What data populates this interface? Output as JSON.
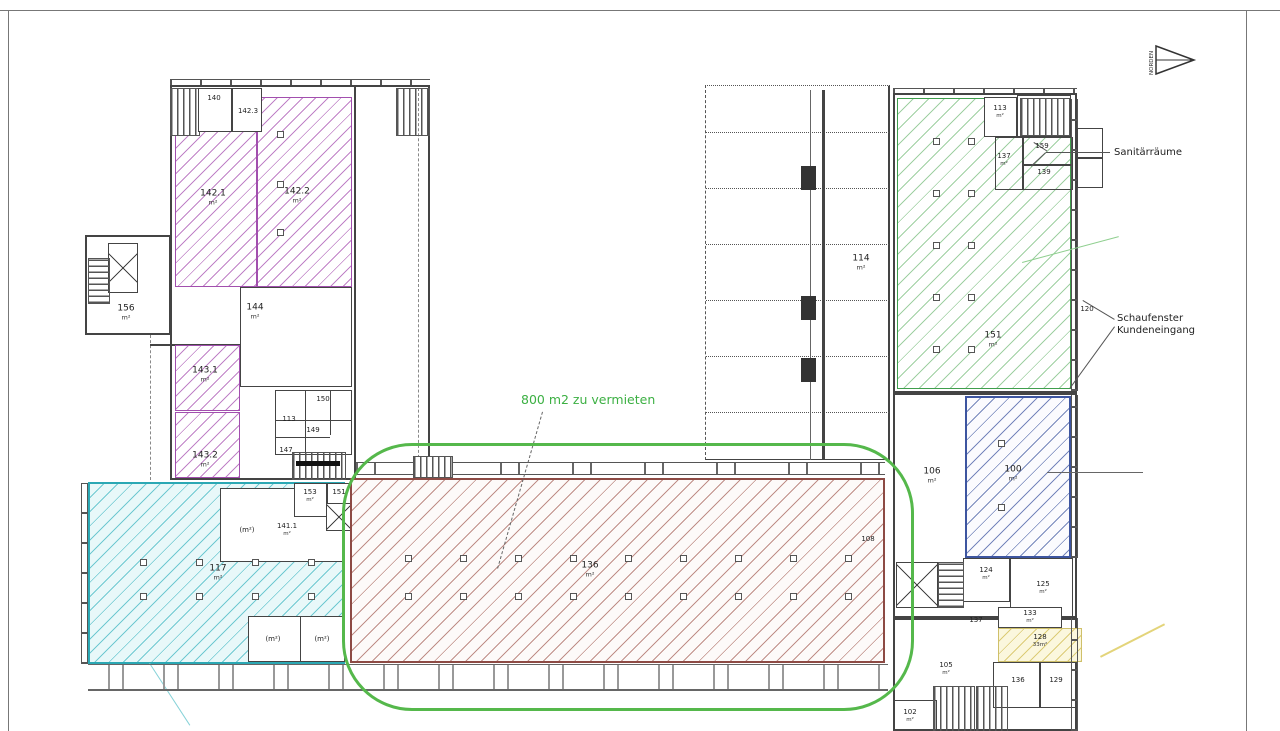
{
  "annotations": {
    "rent": "800 m2 zu vermieten",
    "sanitary": "Sanitärräume",
    "shop1": "Schaufenster",
    "shop2": "Kundeneingang",
    "north": "NORDEN"
  },
  "colors": {
    "purple": "#a24fae",
    "cyan": "#2ba8b4",
    "red": "#8d4a44",
    "green": "#3f9e4d",
    "blue": "#3d55a0",
    "yellow": "#cfc06a",
    "highlight_loop": "#55b84b",
    "annotation_text": "#3cb043"
  },
  "rooms": [
    {
      "num": "140",
      "area": "",
      "x": 214,
      "y": 99,
      "small": true
    },
    {
      "num": "142.3",
      "area": "",
      "x": 248,
      "y": 112,
      "small": true
    },
    {
      "num": "142.1",
      "area": "m²",
      "x": 213,
      "y": 198
    },
    {
      "num": "142.2",
      "area": "m²",
      "x": 297,
      "y": 196
    },
    {
      "num": "156",
      "area": "m²",
      "x": 126,
      "y": 313
    },
    {
      "num": "144",
      "area": "m²",
      "x": 255,
      "y": 312
    },
    {
      "num": "143.1",
      "area": "m²",
      "x": 205,
      "y": 375
    },
    {
      "num": "143.2",
      "area": "m²",
      "x": 205,
      "y": 460
    },
    {
      "num": "150",
      "area": "",
      "x": 323,
      "y": 400,
      "small": true
    },
    {
      "num": "113",
      "area": "",
      "x": 289,
      "y": 420,
      "small": true
    },
    {
      "num": "149",
      "area": "",
      "x": 313,
      "y": 431,
      "small": true
    },
    {
      "num": "147",
      "area": "",
      "x": 286,
      "y": 451,
      "small": true
    },
    {
      "num": "153",
      "area": "m²",
      "x": 310,
      "y": 496,
      "small": true
    },
    {
      "num": "151",
      "area": "",
      "x": 339,
      "y": 493,
      "small": true
    },
    {
      "num": "141.1",
      "area": "m²",
      "x": 287,
      "y": 530,
      "small": true
    },
    {
      "num": "(m²)",
      "area": "",
      "x": 247,
      "y": 531,
      "small": true
    },
    {
      "num": "117",
      "area": "m²",
      "x": 218,
      "y": 573
    },
    {
      "num": "(m²)",
      "area": "",
      "x": 273,
      "y": 640,
      "small": true
    },
    {
      "num": "(m²)",
      "area": "",
      "x": 322,
      "y": 640,
      "small": true
    },
    {
      "num": "136",
      "area": "m²",
      "x": 590,
      "y": 570
    },
    {
      "num": "114",
      "area": "m²",
      "x": 861,
      "y": 263
    },
    {
      "num": "151",
      "area": "m²",
      "x": 993,
      "y": 340
    },
    {
      "num": "113",
      "area": "m²",
      "x": 1000,
      "y": 112,
      "small": true
    },
    {
      "num": "137",
      "area": "m²",
      "x": 1004,
      "y": 160,
      "small": true
    },
    {
      "num": "159",
      "area": "",
      "x": 1042,
      "y": 147,
      "small": true
    },
    {
      "num": "139",
      "area": "",
      "x": 1044,
      "y": 173,
      "small": true
    },
    {
      "num": "120",
      "area": "",
      "x": 1087,
      "y": 310,
      "small": true
    },
    {
      "num": "100",
      "area": "m²",
      "x": 1013,
      "y": 474
    },
    {
      "num": "106",
      "area": "m²",
      "x": 932,
      "y": 476
    },
    {
      "num": "108",
      "area": "",
      "x": 868,
      "y": 540,
      "small": true
    },
    {
      "num": "124",
      "area": "m²",
      "x": 986,
      "y": 574,
      "small": true
    },
    {
      "num": "125",
      "area": "m²",
      "x": 1043,
      "y": 588,
      "small": true
    },
    {
      "num": "137",
      "area": "",
      "x": 976,
      "y": 621,
      "small": true
    },
    {
      "num": "133",
      "area": "m²",
      "x": 1030,
      "y": 617,
      "small": true
    },
    {
      "num": "128",
      "area": "33m²",
      "x": 1040,
      "y": 641,
      "small": true
    },
    {
      "num": "136",
      "area": "",
      "x": 1018,
      "y": 681,
      "small": true
    },
    {
      "num": "129",
      "area": "",
      "x": 1056,
      "y": 681,
      "small": true
    },
    {
      "num": "105",
      "area": "m²",
      "x": 946,
      "y": 669,
      "small": true
    },
    {
      "num": "102",
      "area": "m²",
      "x": 910,
      "y": 716,
      "small": true
    }
  ]
}
